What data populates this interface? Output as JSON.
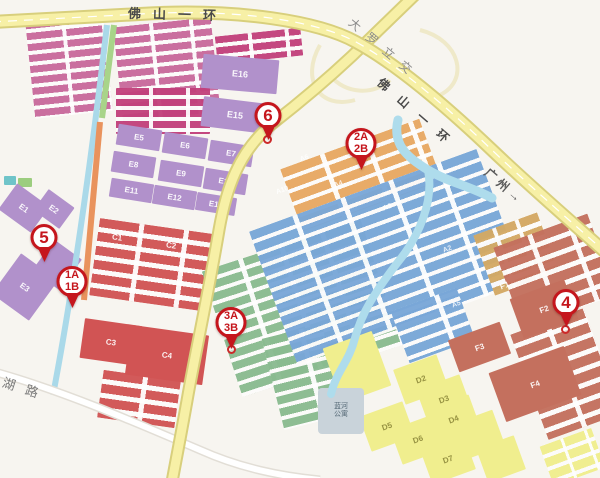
{
  "roads": {
    "top_ring": "佛山一环",
    "diagonal_ring": "佛山一环",
    "direction_guangzhou": "广州→",
    "interchange": "大罗立交",
    "lake_road": "湖路"
  },
  "places": {
    "apartment_line1": "蓝河",
    "apartment_line2": "公寓"
  },
  "blocks": {
    "e1": "E1",
    "e2": "E2",
    "e3": "E3",
    "e5": "E5",
    "e6": "E6",
    "e7": "E7",
    "e8": "E8",
    "e9": "E9",
    "e10": "E10",
    "e11": "E11",
    "e12": "E12",
    "e13": "E13",
    "e15": "E15",
    "e16": "E16",
    "c1": "C1",
    "c2": "C2",
    "c3": "C3",
    "c4": "C4",
    "a2": "A2",
    "a3": "A3",
    "a4": "A4",
    "a5": "A5",
    "a6": "A6",
    "a10": "A10",
    "d2": "D2",
    "d3": "D3",
    "d4": "D4",
    "d5": "D5",
    "d6": "D6",
    "d7": "D7",
    "f1": "F1",
    "f2": "F2",
    "f3": "F3",
    "f4": "F4"
  },
  "markers": {
    "m1": {
      "lines": [
        "1A",
        "1B"
      ]
    },
    "m2": {
      "lines": [
        "2A",
        "2B"
      ]
    },
    "m3": {
      "lines": [
        "3A",
        "3B"
      ]
    },
    "m4": {
      "lines": [
        "4"
      ]
    },
    "m5": {
      "lines": [
        "5"
      ]
    },
    "m6": {
      "lines": [
        "6"
      ]
    }
  },
  "colors": {
    "marker_red": "#c5161d",
    "road_yellow": "#f7f0a6",
    "road_casing": "#d8cf7c",
    "river_blue": "#aedcec",
    "zone_pink": "#c96a9c",
    "zone_crimson": "#c2417c",
    "zone_purple": "#b191cb",
    "zone_red": "#d15454",
    "zone_green": "#8abb90",
    "zone_blue": "#79a7d8",
    "zone_orange": "#e8a963",
    "zone_tan": "#d4a964",
    "zone_yellow": "#f0ee8e",
    "zone_brown": "#c4705e",
    "background": "#f7f5f0"
  }
}
